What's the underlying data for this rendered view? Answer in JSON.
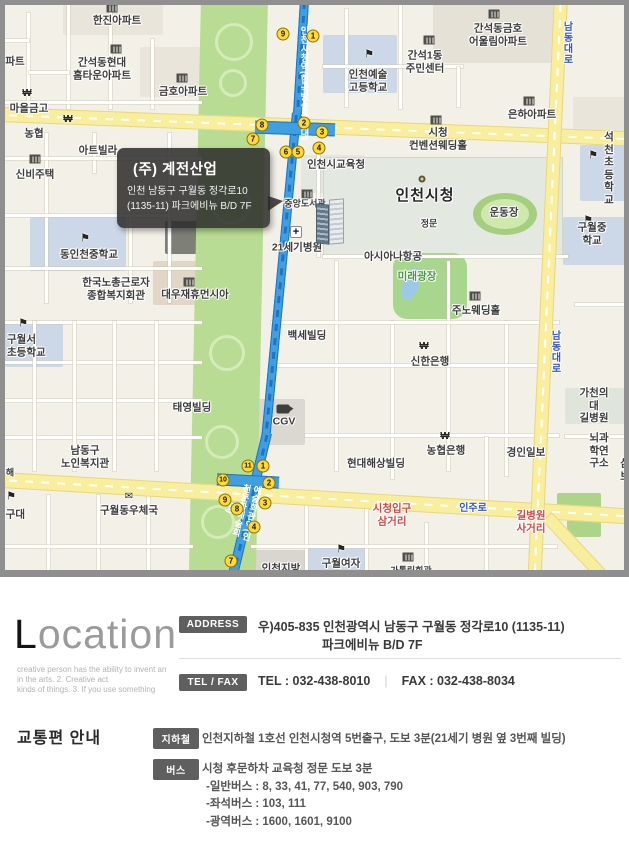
{
  "map": {
    "callout": {
      "title": "(주) 계전산업",
      "line1": "인천 남동구 구월동 정각로10",
      "line2": "(1135-11) 파크에비뉴 B/D 7F"
    },
    "labels": [
      {
        "t": "한진아파트",
        "x": 112,
        "y": 16
      },
      {
        "t": "간석동현대\n홈타운아파트",
        "x": 97,
        "y": 64
      },
      {
        "t": "금호아파트",
        "x": 178,
        "y": 87
      },
      {
        "t": "파트",
        "x": 10,
        "y": 57
      },
      {
        "t": "마을금고",
        "x": 24,
        "y": 104
      },
      {
        "t": "농협",
        "x": 29,
        "y": 129
      },
      {
        "t": "아트빌라",
        "x": 93,
        "y": 146
      },
      {
        "t": "신비주택",
        "x": 30,
        "y": 170
      },
      {
        "t": "간석동금호\n어울림아파트",
        "x": 493,
        "y": 30
      },
      {
        "t": "간석1동\n주민센터",
        "x": 420,
        "y": 57
      },
      {
        "t": "인천예술\n고등학교",
        "x": 363,
        "y": 76
      },
      {
        "t": "은하아파트",
        "x": 527,
        "y": 110
      },
      {
        "t": "시청\n컨벤션웨딩홀",
        "x": 433,
        "y": 134
      },
      {
        "t": "인천시교육청",
        "x": 331,
        "y": 160
      },
      {
        "t": "인천시청",
        "x": 420,
        "y": 191,
        "c": "big"
      },
      {
        "t": "운동장",
        "x": 499,
        "y": 208
      },
      {
        "t": "정문",
        "x": 424,
        "y": 219,
        "c": "sm"
      },
      {
        "t": "석천초등학교",
        "x": 604,
        "y": 164
      },
      {
        "t": "구월중학교",
        "x": 587,
        "y": 229
      },
      {
        "t": "아시아나항공",
        "x": 388,
        "y": 252
      },
      {
        "t": "미래광장",
        "x": 412,
        "y": 272,
        "c": "grn"
      },
      {
        "t": "주노웨딩홀",
        "x": 471,
        "y": 306
      },
      {
        "t": "중앙도서관",
        "x": 300,
        "y": 199,
        "c": "sm"
      },
      {
        "t": "21세기병원",
        "x": 292,
        "y": 243
      },
      {
        "t": "동인천중학교",
        "x": 84,
        "y": 250
      },
      {
        "t": "한국노총근로자\n종합복지회관",
        "x": 111,
        "y": 284
      },
      {
        "t": "대우재휴먼시아",
        "x": 190,
        "y": 290
      },
      {
        "t": "구월서\n초등학교",
        "x": 2,
        "y": 341,
        "c": "cl"
      },
      {
        "t": "백세빌딩",
        "x": 302,
        "y": 331
      },
      {
        "t": "신한은행",
        "x": 425,
        "y": 357
      },
      {
        "t": "태영빌딩",
        "x": 187,
        "y": 403
      },
      {
        "t": "CGV",
        "x": 279,
        "y": 417
      },
      {
        "t": "남동구\n노인복지관",
        "x": 80,
        "y": 452
      },
      {
        "t": "구월동우체국",
        "x": 124,
        "y": 506
      },
      {
        "t": "지구대",
        "x": -9,
        "y": 510,
        "c": "cl"
      },
      {
        "t": "현대해상빌딩",
        "x": 371,
        "y": 459
      },
      {
        "t": "농협은행",
        "x": 441,
        "y": 446
      },
      {
        "t": "경인일보",
        "x": 521,
        "y": 448
      },
      {
        "t": "가천의대\n길병원",
        "x": 589,
        "y": 401
      },
      {
        "t": "뇌과학연구소",
        "x": 594,
        "y": 446
      },
      {
        "t": "삼보",
        "x": 620,
        "y": 465
      },
      {
        "t": "시청입구\n삼거리",
        "x": 387,
        "y": 510,
        "c": "red"
      },
      {
        "t": "인주로",
        "x": 468,
        "y": 504,
        "c": "blu"
      },
      {
        "t": "길병원\n사거리",
        "x": 526,
        "y": 517,
        "c": "red"
      },
      {
        "t": "인천지방",
        "x": 276,
        "y": 564
      },
      {
        "t": "구월여자",
        "x": 336,
        "y": 559
      },
      {
        "t": "가톨릭회관",
        "x": 406,
        "y": 566,
        "c": "sm"
      },
      {
        "t": "해",
        "x": 5,
        "y": 468,
        "c": "sm"
      },
      {
        "t": "남동대로",
        "x": 561,
        "y": 38,
        "c": "vrd"
      },
      {
        "t": "남동대로",
        "x": 549,
        "y": 347,
        "c": "vrd"
      },
      {
        "t": "인천시청역(한국방송통신대)",
        "x": 299,
        "y": 78,
        "c": "stav"
      },
      {
        "t": "예술회관역(인천문화예술회관)",
        "x": 236,
        "y": 505,
        "c": "stav2"
      }
    ],
    "exits": [
      {
        "n": "9",
        "x": 278,
        "y": 29
      },
      {
        "n": "1",
        "x": 308,
        "y": 31
      },
      {
        "n": "8",
        "x": 257,
        "y": 120
      },
      {
        "n": "2",
        "x": 299,
        "y": 118
      },
      {
        "n": "3",
        "x": 317,
        "y": 127
      },
      {
        "n": "7",
        "x": 248,
        "y": 134
      },
      {
        "n": "4",
        "x": 314,
        "y": 143
      },
      {
        "n": "5",
        "x": 293,
        "y": 147
      },
      {
        "n": "6",
        "x": 281,
        "y": 147
      },
      {
        "n": "11",
        "x": 243,
        "y": 461
      },
      {
        "n": "1",
        "x": 258,
        "y": 461
      },
      {
        "n": "10",
        "x": 218,
        "y": 475
      },
      {
        "n": "2",
        "x": 264,
        "y": 478
      },
      {
        "n": "9",
        "x": 220,
        "y": 495
      },
      {
        "n": "3",
        "x": 260,
        "y": 498
      },
      {
        "n": "8",
        "x": 232,
        "y": 504
      },
      {
        "n": "4",
        "x": 249,
        "y": 522
      },
      {
        "n": "7",
        "x": 226,
        "y": 556
      }
    ],
    "icons": [
      {
        "k": "bld",
        "x": 107,
        "y": 3
      },
      {
        "k": "bld",
        "x": 111,
        "y": 44
      },
      {
        "k": "bld",
        "x": 177,
        "y": 73
      },
      {
        "k": "bld",
        "x": 30,
        "y": 154
      },
      {
        "k": "bld",
        "x": 489,
        "y": 9
      },
      {
        "k": "bld",
        "x": 424,
        "y": 35
      },
      {
        "k": "bld",
        "x": 524,
        "y": 96
      },
      {
        "k": "bld",
        "x": 431,
        "y": 115
      },
      {
        "k": "bld",
        "x": 470,
        "y": 291
      },
      {
        "k": "bld",
        "x": 184,
        "y": 277
      },
      {
        "k": "bld",
        "x": 302,
        "y": 189
      },
      {
        "k": "bld",
        "x": 403,
        "y": 552
      },
      {
        "k": "flag",
        "x": 364,
        "y": 50
      },
      {
        "k": "flag",
        "x": 588,
        "y": 151
      },
      {
        "k": "flag",
        "x": 583,
        "y": 216
      },
      {
        "k": "flag",
        "x": 80,
        "y": 234
      },
      {
        "k": "flag",
        "x": 18,
        "y": 319
      },
      {
        "k": "flag",
        "x": 6,
        "y": 492
      },
      {
        "k": "flag",
        "x": 336,
        "y": 545
      },
      {
        "k": "won",
        "x": 22,
        "y": 89
      },
      {
        "k": "won",
        "x": 63,
        "y": 115
      },
      {
        "k": "won",
        "x": 419,
        "y": 342
      },
      {
        "k": "won",
        "x": 440,
        "y": 432
      },
      {
        "k": "hosp",
        "x": 291,
        "y": 227
      },
      {
        "k": "post",
        "x": 124,
        "y": 492
      },
      {
        "k": "cam",
        "x": 278,
        "y": 404
      },
      {
        "k": "dot",
        "x": 417,
        "y": 174
      }
    ]
  },
  "location": {
    "title_cap": "L",
    "title_rest": "ocation",
    "subtitle_lines": [
      "creative person has the ability to invent an",
      "in the arts. 2. Creative act",
      "kinds of things. 3. If you use something"
    ],
    "address_badge": "ADDRESS",
    "address_line1": "우)405-835 인천광역시 남동구 구월동 정각로10 (1135-11)",
    "address_line2": "파크에비뉴 B/D 7F",
    "telfax_badge": "TEL / FAX",
    "tel": "TEL : 032-438-8010",
    "fax": "FAX : 032-438-8034"
  },
  "transport": {
    "title": "교통편 안내",
    "subway_badge": "지하철",
    "subway_text": "인천지하철 1호선 인천시청역 5번출구, 도보 3분(21세기 병원 옆 3번째 빌딩)",
    "bus_badge": "버스",
    "bus_lines": [
      "시청 후문하차 교육청 정문 도보 3분",
      "-일반버스 : 8, 33, 41, 77, 540, 903, 790",
      "-좌석버스 : 103, 111",
      "-광역버스 : 1600, 1601, 9100"
    ]
  },
  "colors": {
    "road_yellow": "#f8ee9e",
    "park_green": "#b8dc93",
    "subway_blue": "#3f9fe0",
    "badge_gray": "#5f5f5f",
    "label_red": "#c84b4b",
    "label_blue": "#3455c4",
    "exit_yellow": "#ffd83a"
  }
}
